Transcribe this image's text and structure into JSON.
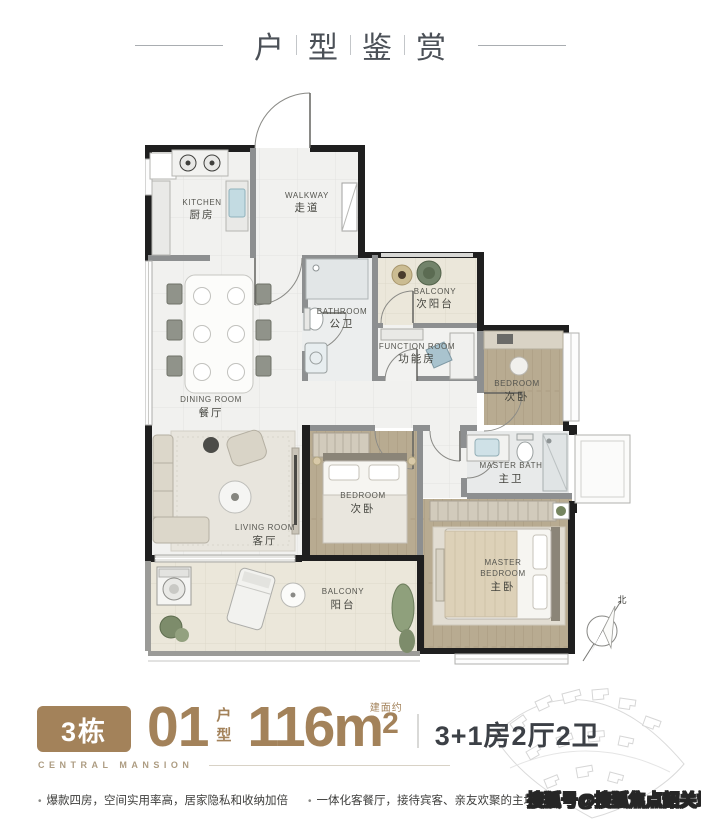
{
  "header": {
    "title_chars": [
      "户",
      "型",
      "鉴",
      "赏"
    ]
  },
  "plan": {
    "rooms": {
      "kitchen": {
        "en": "KITCHEN",
        "cn": "厨房"
      },
      "walkway": {
        "en": "WALKWAY",
        "cn": "走道"
      },
      "bathroom": {
        "en": "BATHROOM",
        "cn": "公卫"
      },
      "north_balcony": {
        "en": "BALCONY",
        "cn": "次阳台"
      },
      "function_room": {
        "en": "FUNCTION ROOM",
        "cn": "功能房"
      },
      "bedroom_ne": {
        "en": "BEDROOM",
        "cn": "次卧"
      },
      "dining": {
        "en": "DINING ROOM",
        "cn": "餐厅"
      },
      "living": {
        "en": "LIVING ROOM",
        "cn": "客厅"
      },
      "master_bath": {
        "en": "MASTER BATH",
        "cn": "主卫"
      },
      "bedroom_mid": {
        "en": "BEDROOM",
        "cn": "次卧"
      },
      "master_bedroom": {
        "en1": "MASTER",
        "en2": "BEDROOM",
        "cn": "主卧"
      },
      "south_balcony": {
        "en": "BALCONY",
        "cn": "阳台"
      }
    },
    "compass_label": "北"
  },
  "info": {
    "building_badge": "3栋",
    "unit_number": "01",
    "unit_char_top": "户",
    "unit_char_bottom": "型",
    "area_prefix": "建面约",
    "area_value": "116m",
    "area_sup": "2",
    "layout_spec": "3+1房2厅2卫",
    "brand": "CENTRAL MANSION"
  },
  "features": {
    "item1": "爆款四房，空间实用率高，居家隐私和收纳加倍",
    "item2": "一体化客餐厅，接待宾客、亲友欢聚的主场"
  },
  "watermark": "搜狐号@搜狐焦点韶关站",
  "colors": {
    "brand_brown": "#a3825a",
    "wall_black": "#1f1f1f",
    "text_dark": "#3c4046"
  }
}
